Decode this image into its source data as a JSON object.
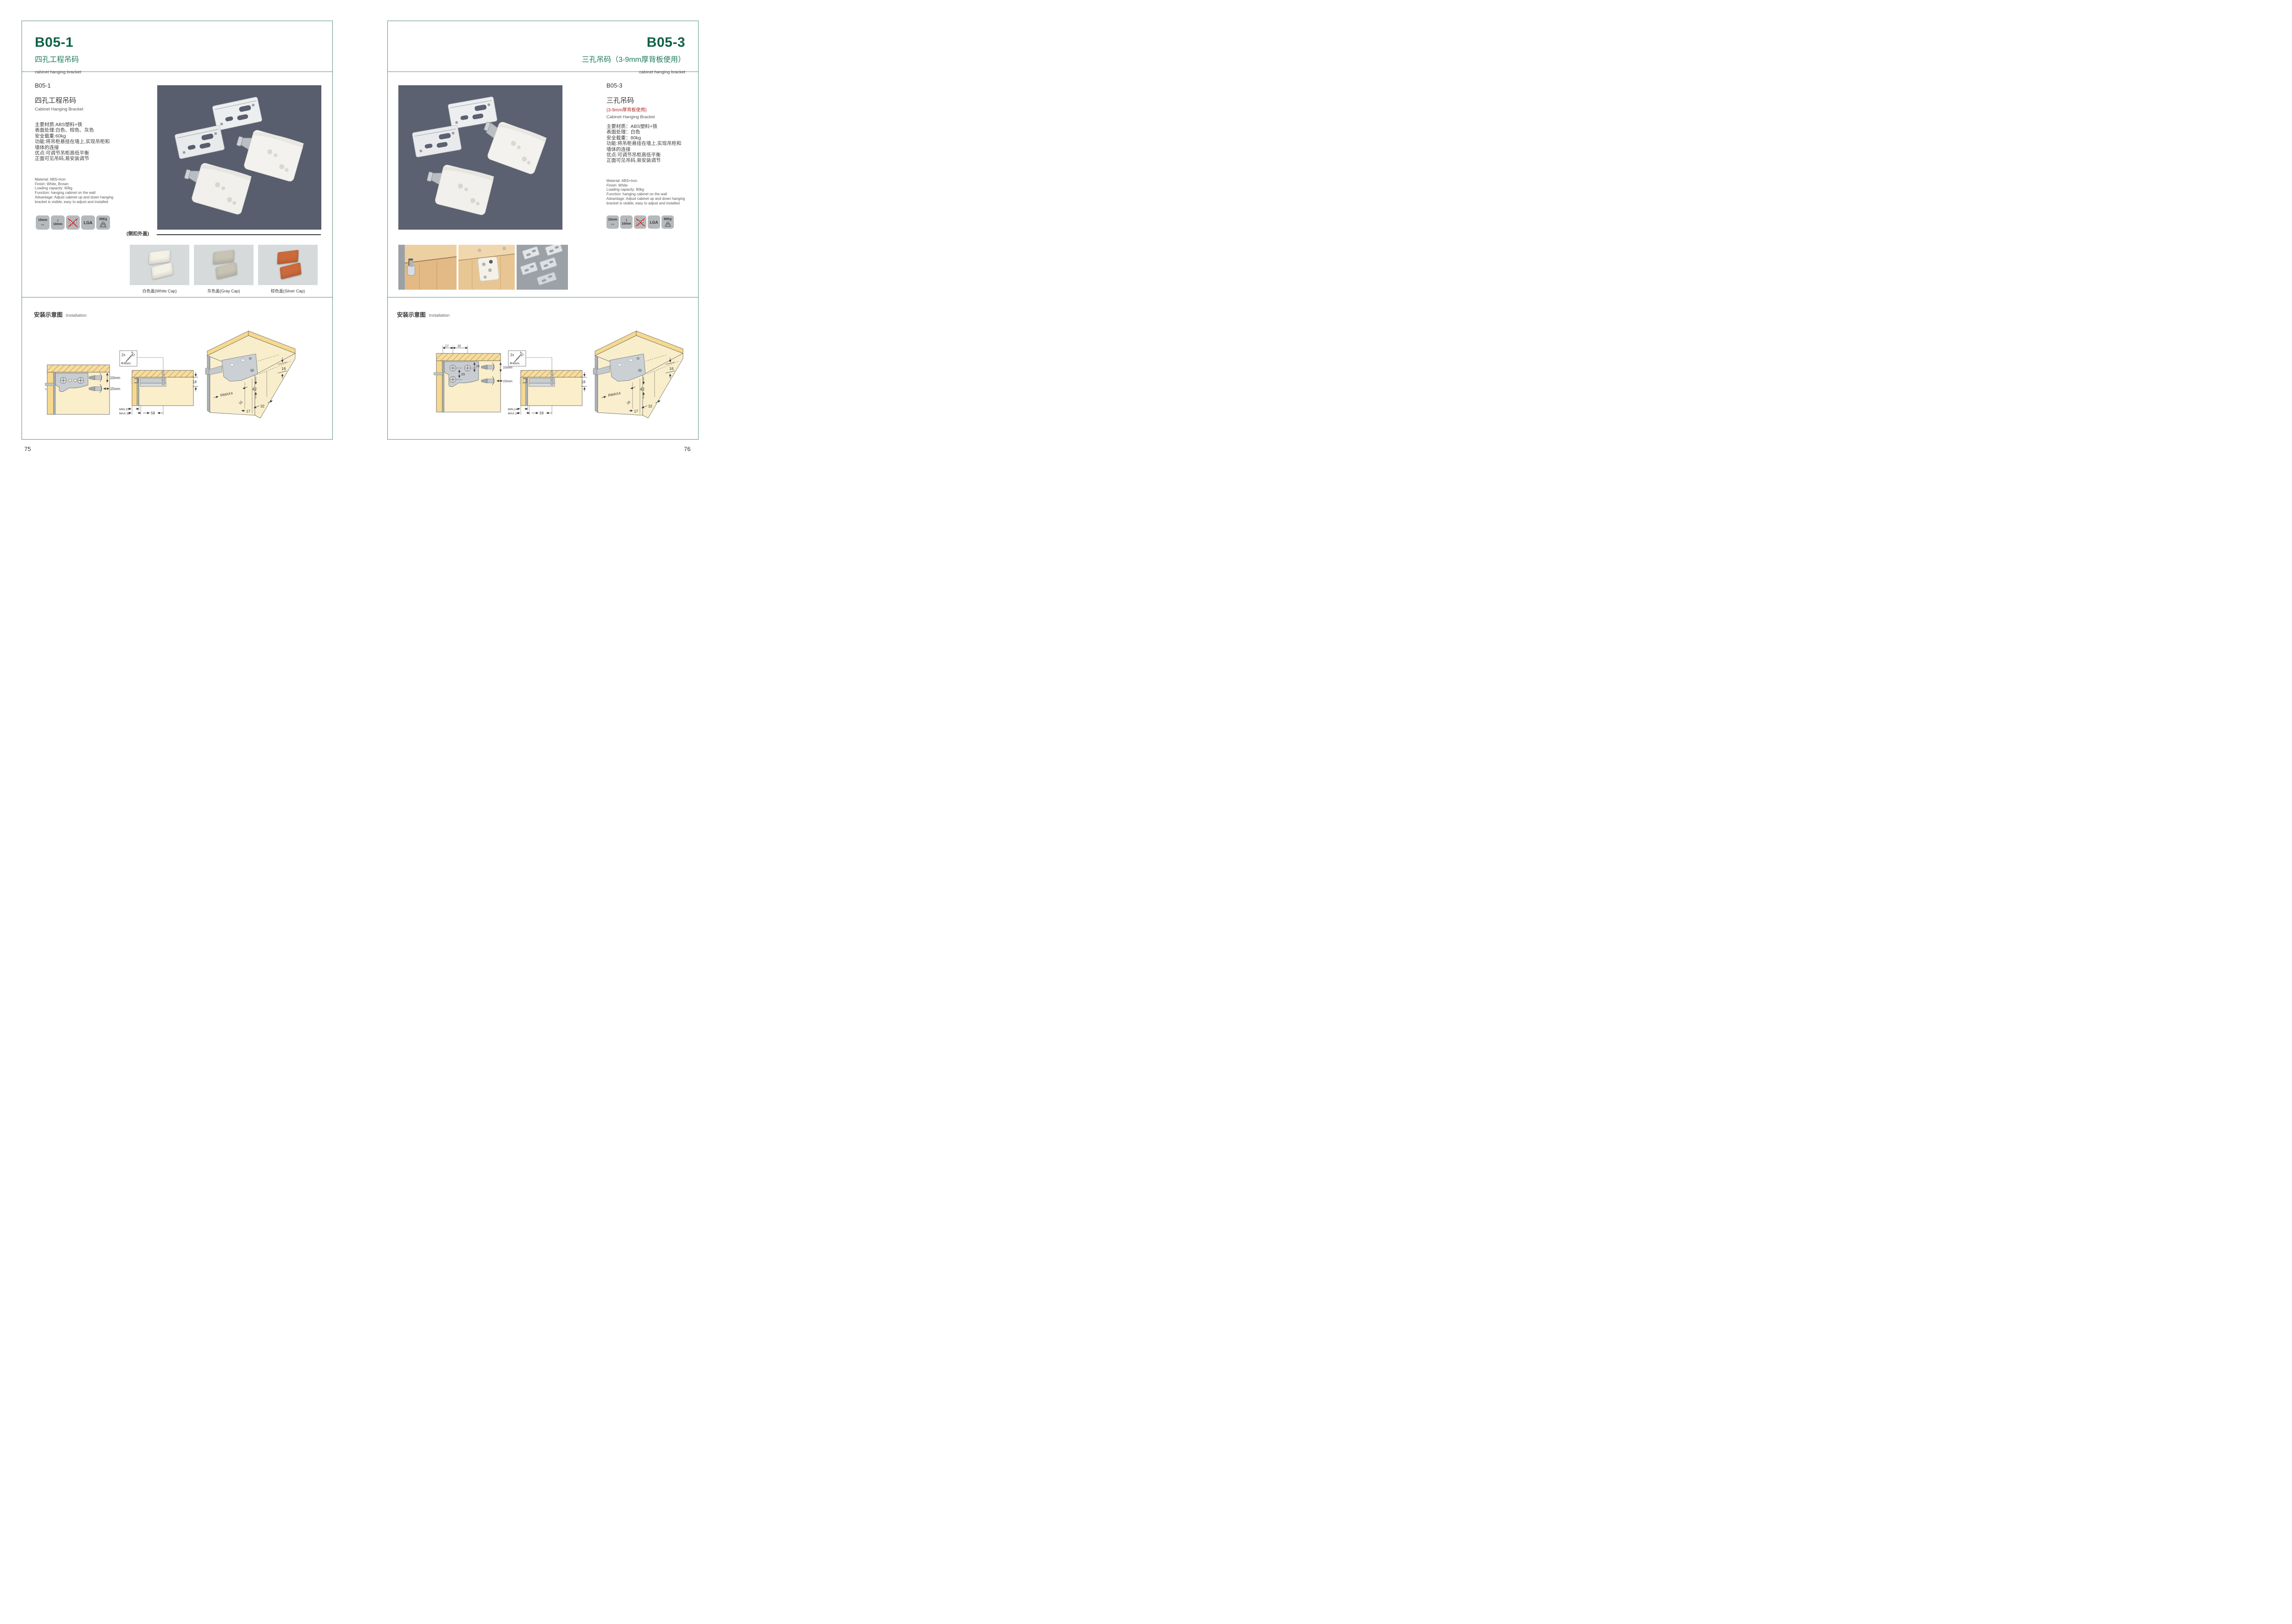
{
  "left": {
    "header": {
      "code": "B05-1",
      "title_zh": "四孔工程吊码",
      "subtitle": "cabinet hanging bracket"
    },
    "product": {
      "code": "B05-1",
      "name_zh": "四孔工程吊码",
      "name_en": "Cabinet Hanging Bracket",
      "specs_zh": [
        "主要材质:ABS塑料+铁",
        "表面处理:白色、棕色、灰色",
        "安全载重:60kg",
        "功能:将吊柜悬挂在墙上,实现吊柜和",
        "墙体的连接",
        "优点:可调节吊柜高低平衡",
        "正面可见吊码,易安装调节"
      ],
      "specs_en": [
        "Material: ABS+Iron",
        "Finish: White, Brown",
        "Loading capacity: 60kg",
        "Function: hanging cabinet on the wall",
        "Advantage: Adjust cabinet up and down hanging",
        "bracket is visible, easy to adjust and installed"
      ]
    },
    "icons": {
      "width": "15mm",
      "height": "10mm",
      "no_drill": "no-drill-icon",
      "cert": "LGA",
      "load": "60Kg"
    },
    "caps": {
      "section_label": "(侧扣外盖)",
      "items": [
        {
          "label": "白色盖(White Cap)",
          "color": "#f4f1e6"
        },
        {
          "label": "灰色盖(Gray Cap)",
          "color": "#c7c3b5"
        },
        {
          "label": "棕色盖(Silver Cap)",
          "color": "#cb6a3c"
        }
      ]
    },
    "installation": {
      "label_zh": "安装示意图",
      "label_en": "Installation",
      "d1": {
        "dim_v": "10mm",
        "dim_h": "15mm"
      },
      "d2": {
        "qty": "2x",
        "screw": "Φ4mm",
        "dim_side": "18",
        "min": "MIN.10",
        "max": "MAX.23",
        "span": "58"
      },
      "d3": {
        "top": "16",
        "height": "42",
        "radius": "RMAX4",
        "back": "16",
        "off1": "17",
        "off2": "32"
      }
    },
    "page_number": "75"
  },
  "right": {
    "header": {
      "code": "B05-3",
      "title_zh": "三孔吊码（3-9mm厚背板使用）",
      "subtitle": "cabinet hanging bracket"
    },
    "product": {
      "code": "B05-3",
      "name_zh": "三孔吊码",
      "name_note": "(3-9mm厚背板使用)",
      "name_en": "Cabinet Hanging Bracket",
      "specs_zh": [
        "主要材质：ABS塑料+铁",
        "表面处理：白色",
        "安全载重：80kg",
        "功能:将吊柜悬挂在墙上,实现吊柜和",
        "墙体的连接",
        "优点:可调节吊柜高低平衡",
        "正面可见吊码,易安装调节"
      ],
      "specs_en": [
        "Material: ABS+Iron",
        "Finish: White",
        "Loading capacity: 80kg",
        "Function: hanging cabinet on the wall",
        "Advantage: Adjust cabinet up and down hanging",
        "bracket is visible, easy to adjust and installed"
      ]
    },
    "icons": {
      "width": "15mm",
      "height": "10mm",
      "no_drill": "no-drill-icon",
      "cert": "LGA",
      "load": "80Kg"
    },
    "installation": {
      "label_zh": "安装示意图",
      "label_en": "Installation",
      "d1": {
        "off1": "17",
        "off2": "32",
        "dim_a": "16",
        "dim_b": "25",
        "dim_v": "10mm",
        "dim_h": "15mm"
      },
      "d2": {
        "qty": "2x",
        "screw": "Φ4mm",
        "dim_side": "18",
        "min": "MIN.14",
        "max": "MAX.24",
        "span": "58"
      },
      "d3": {
        "top": "16",
        "height": "42",
        "radius": "RMAX4",
        "back": "18",
        "off1": "17",
        "off2": "32"
      }
    },
    "page_number": "76"
  }
}
